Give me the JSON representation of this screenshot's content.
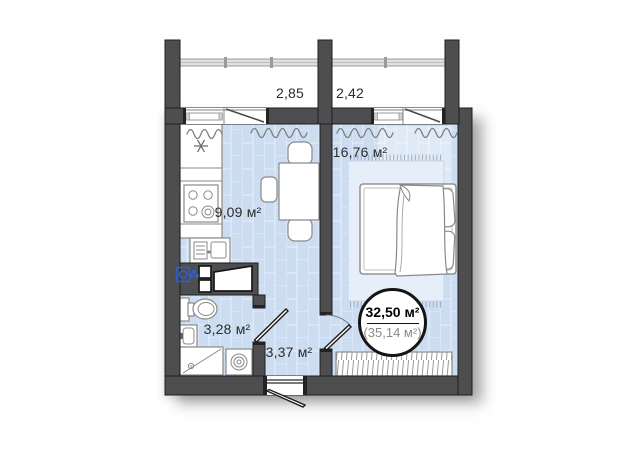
{
  "balconies": [
    {
      "area": "2,85"
    },
    {
      "area": "2,42"
    }
  ],
  "rooms": {
    "kitchen": {
      "area": "9,09 м²"
    },
    "living": {
      "area": "16,76 м²"
    },
    "bathroom": {
      "area": "3,28 м²"
    },
    "hallway": {
      "area": "3,37 м²"
    }
  },
  "total_badge": {
    "area_main": "32,50 м²",
    "area_secondary": "(35,14 м²)"
  },
  "icons": {
    "fridge": "snowflake-icon",
    "stove": "four-burner-stove-icon",
    "washer_marker": "washing-machine-blue-icon",
    "dryer_marker": "dryer-blue-icon"
  },
  "colors": {
    "wall": "#4e4d4f",
    "outline": "#1e1e1e",
    "floor": "#cdddf1",
    "floor_light": "#e6eefa",
    "furniture_stroke": "#8a8a8a",
    "appliance_blue": "#2f5ed2",
    "label": "#2c2c2c",
    "badge_secondary": "#8a8a8a"
  }
}
